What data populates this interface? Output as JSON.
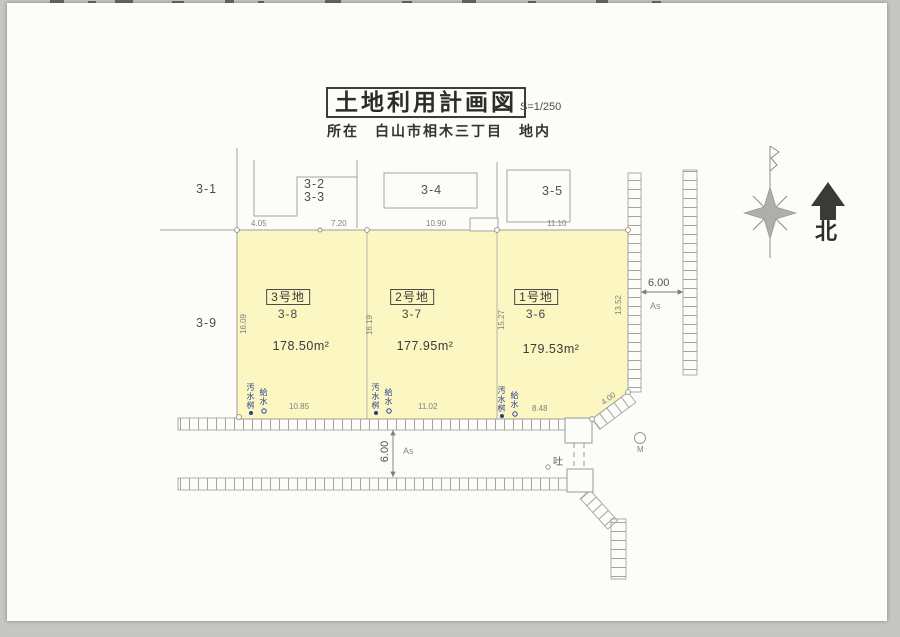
{
  "header": {
    "title": "土地利用計画図",
    "scale": "S=1/250",
    "location": "所在　白山市相木三丁目　地内"
  },
  "compass": {
    "north": "北"
  },
  "parcels": [
    {
      "name": "1号地",
      "lot": "3-6",
      "area": "179.53m²"
    },
    {
      "name": "2号地",
      "lot": "3-7",
      "area": "177.95m²"
    },
    {
      "name": "3号地",
      "lot": "3-8",
      "area": "178.50m²"
    }
  ],
  "neighbors": {
    "n31": "3-1",
    "n32": "3-2",
    "n33": "3-3",
    "n34": "3-4",
    "n35": "3-5",
    "n39": "3-9"
  },
  "dims": {
    "top": [
      "4.05",
      "7.20",
      "10.90",
      "11.10"
    ],
    "bottom": [
      "10.85",
      "11.02",
      "8.48"
    ],
    "sides": [
      "16.09",
      "16.19",
      "15.27",
      "13.52"
    ],
    "chamfer": "4.00",
    "south_road_width": "6.00",
    "east_road_width": "6.00"
  },
  "surfaces": {
    "south": "As",
    "east": "As"
  },
  "utilities": {
    "sewer": "汚水桝",
    "water": "給水",
    "outlet": "吐",
    "manhole": "M"
  },
  "colors": {
    "parcel_fill": "#fbf6c2",
    "line_gray": "#a3a19c",
    "dim_text": "#83817c",
    "utility_blue": "#27418f",
    "north_arrow": "#3a3a38"
  }
}
